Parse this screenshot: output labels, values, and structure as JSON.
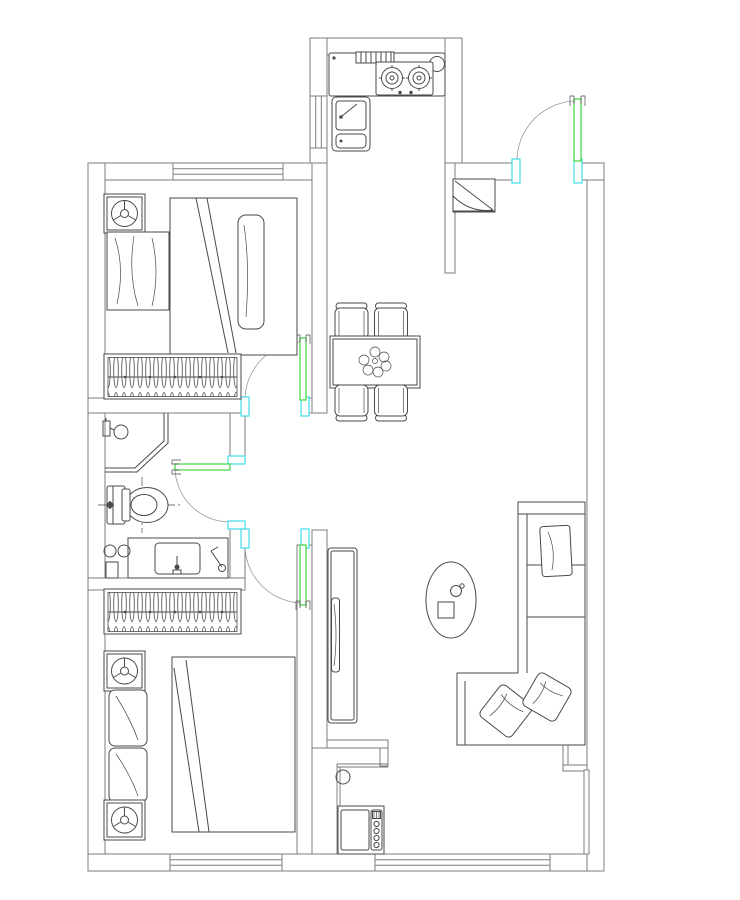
{
  "drawing": {
    "kind": "apartment-floor-plan",
    "style": "CAD line drawing, top view, no text labels",
    "canvas": {
      "width": 740,
      "height": 900
    }
  },
  "colors": {
    "background": "#ffffff",
    "wall_line": "#7d7d7d",
    "furniture_line": "#4a4a4a",
    "door_leaf": "#3fd23f",
    "door_frame_mark": "#3fdbe8",
    "door_swing_arc": "#9a9a9a"
  },
  "rooms": [
    {
      "id": "master-bedroom",
      "area": "top-left",
      "items": [
        "nightstand-with-lamp",
        "single-bed",
        "pillow",
        "folded-quilt",
        "wardrobe-with-hangers",
        "window-top"
      ]
    },
    {
      "id": "bathroom",
      "area": "middle-left",
      "items": [
        "corner-shower",
        "shower-head",
        "toilet",
        "vanity-with-sink",
        "hairdryer-symbol",
        "service-taps",
        "floor-box"
      ]
    },
    {
      "id": "second-bedroom",
      "area": "bottom-left",
      "items": [
        "wardrobe-with-hangers",
        "nightstand-with-lamp-upper",
        "nightstand-with-lamp-lower",
        "double-bed",
        "pillow-upper",
        "pillow-lower",
        "window-bottom"
      ]
    },
    {
      "id": "kitchen",
      "area": "top-middle",
      "items": [
        "counter",
        "vent-grille",
        "round-fixture",
        "two-burner-gas-stove",
        "double-sink-cabinet",
        "side-window"
      ]
    },
    {
      "id": "entry-hall",
      "area": "top-right",
      "items": [
        "entry-door",
        "shoe-cabinet"
      ]
    },
    {
      "id": "dining-area",
      "area": "middle",
      "items": [
        "dining-table",
        "chair-top-left",
        "chair-top-right",
        "chair-bottom-left",
        "chair-bottom-right",
        "centerpiece-plant"
      ]
    },
    {
      "id": "living-room",
      "area": "right",
      "items": [
        "tv-cabinet",
        "tv",
        "oval-coffee-table",
        "coffee-table-tray",
        "coffee-table-cup",
        "l-shaped-sofa",
        "sofa-back-pillow",
        "sofa-corner-pillow-1",
        "sofa-corner-pillow-2"
      ]
    },
    {
      "id": "balcony",
      "area": "bottom",
      "items": [
        "washing-machine",
        "floor-drain",
        "sliding-window"
      ]
    }
  ],
  "doors": [
    {
      "id": "entry-door",
      "location": "top wall, right of kitchen",
      "leaf_color_key": "door_leaf",
      "jamb_color_key": "door_frame_mark",
      "swing": "inward quarter-circle"
    },
    {
      "id": "master-bedroom-door",
      "location": "bedroom bottom wall",
      "swing": "into bedroom"
    },
    {
      "id": "bathroom-door",
      "location": "bathroom right wall",
      "swing": "into bathroom"
    },
    {
      "id": "second-bedroom-door",
      "location": "hall to bedroom",
      "swing": "into bedroom"
    }
  ],
  "windows": [
    {
      "id": "window-master-top",
      "wall": "top"
    },
    {
      "id": "window-kitchen-left",
      "wall": "kitchen left"
    },
    {
      "id": "window-bedroom2-bottom",
      "wall": "bottom"
    },
    {
      "id": "window-balcony-bottom",
      "wall": "bottom"
    }
  ],
  "counts": {
    "chairs": 4,
    "burners": 2,
    "wardrobes": 2,
    "nightstands": 3,
    "sofa_pillows": 3,
    "bed_pillows": 3
  }
}
